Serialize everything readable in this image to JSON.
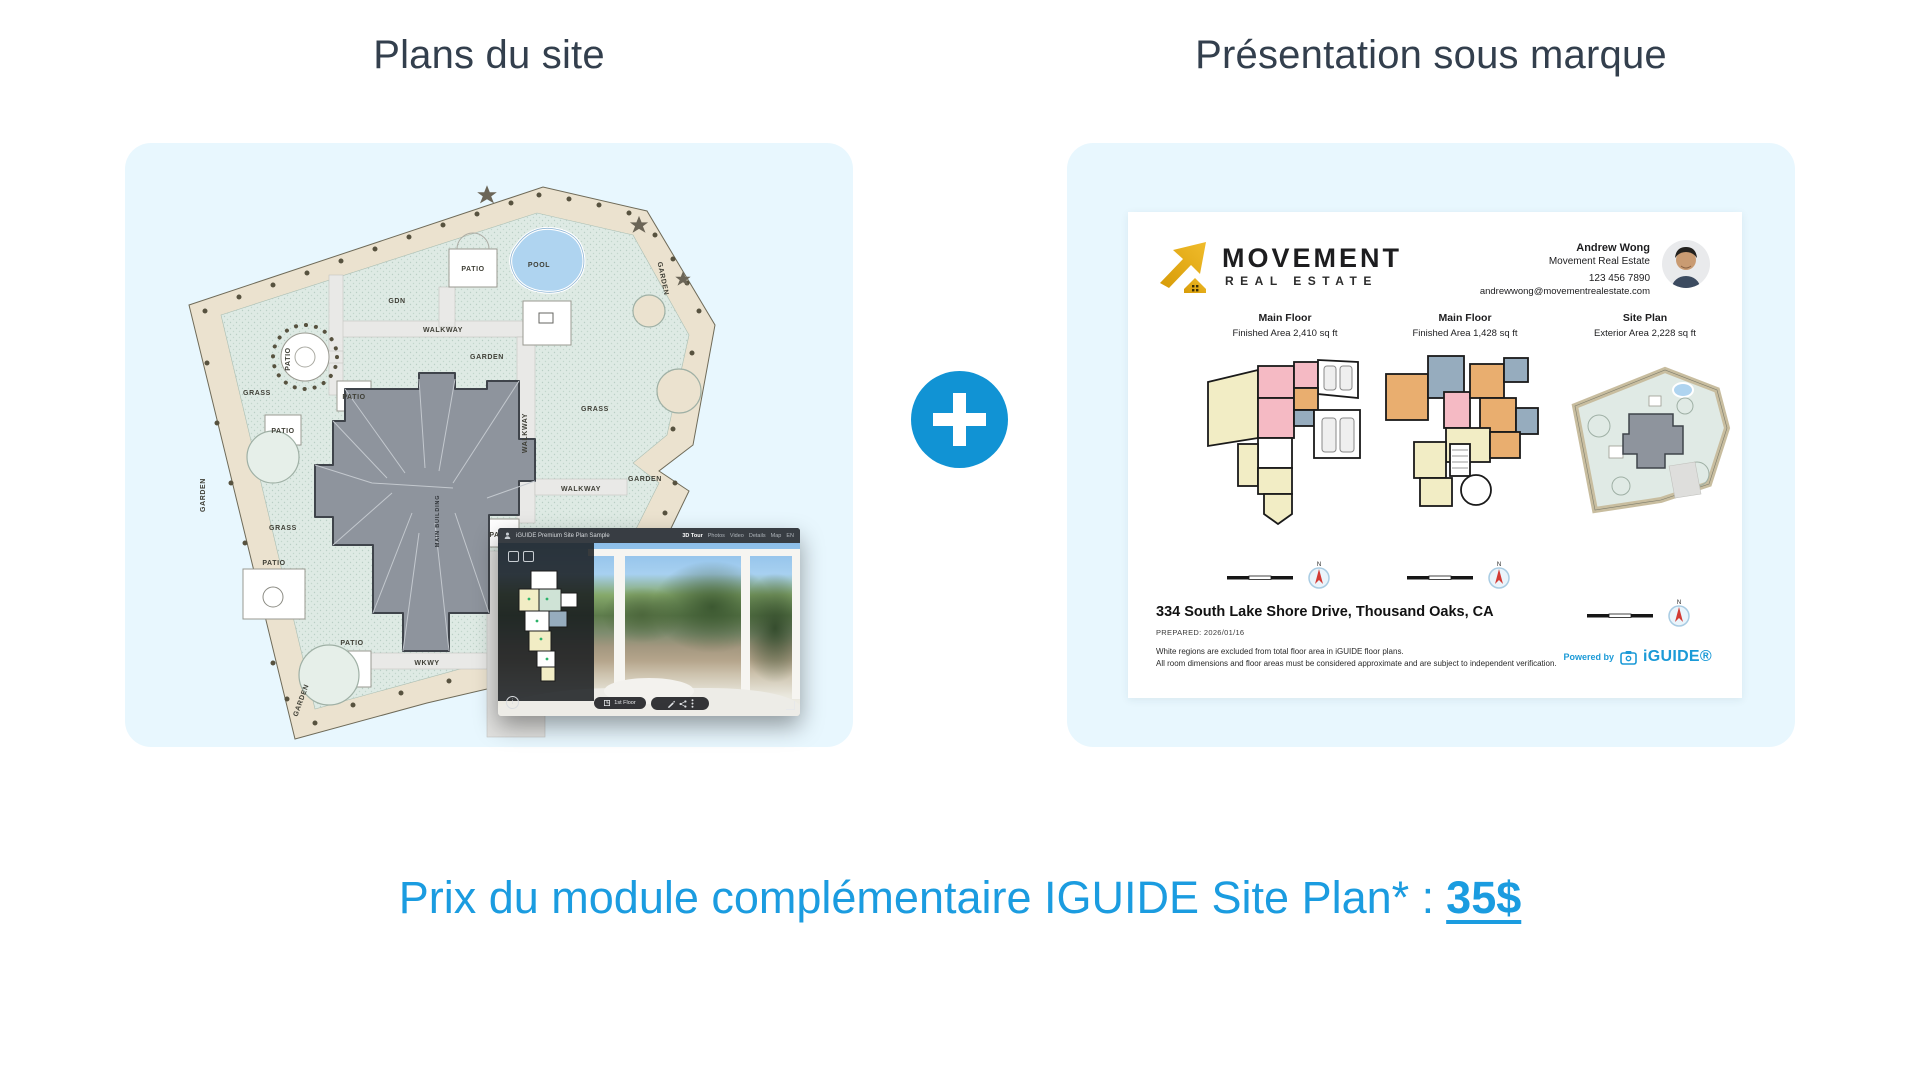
{
  "colors": {
    "accent_text": "#1B9CE0",
    "accent_circle": "#1193D4",
    "card_bg": "#E8F7FE",
    "title": "#333F4D",
    "gold": "#E8B11E",
    "iguide_blue": "#1B9AD7"
  },
  "left_section": {
    "title": "Plans du site",
    "site_plan": {
      "labels": [
        "POOL",
        "PATIO",
        "GARDEN",
        "WALKWAY",
        "GARDEN",
        "GDN",
        "GRASS",
        "GRASS",
        "PATIO",
        "PATIO",
        "PATIO",
        "WALKWAY",
        "WALKWAY",
        "GRASS",
        "GARDEN",
        "GRASS",
        "MAIN BUILDING",
        "PATIO",
        "WKWY",
        "SHED",
        "GRASS",
        "PATIO",
        "PATIO",
        "DRIVEWAY",
        "WKWY",
        "GARDEN",
        "GARDEN"
      ]
    }
  },
  "plus_divider": {
    "symbol": "+"
  },
  "tour_overlay": {
    "topbar_title": "iGUIDE Premium Site Plan Sample",
    "nav": [
      "3D Tour",
      "Photos",
      "Video",
      "Details",
      "Map",
      "EN"
    ],
    "floor_pill": "1st Floor",
    "info_glyph": "i"
  },
  "right_section": {
    "title": "Présentation sous marque",
    "presentation": {
      "brand": {
        "line1": "MOVEMENT",
        "line2": "REAL ESTATE"
      },
      "agent": {
        "name": "Andrew Wong",
        "company": "Movement Real Estate",
        "phone": "123 456 7890",
        "email": "andrewwong@movementrealestate.com"
      },
      "columns": [
        {
          "title": "Main Floor",
          "subtitle": "Finished Area 2,410 sq ft"
        },
        {
          "title": "Main Floor",
          "subtitle": "Finished Area 1,428 sq ft"
        },
        {
          "title": "Site Plan",
          "subtitle": "Exterior Area 2,228 sq ft"
        }
      ],
      "compass_n": "N",
      "address": "334 South Lake Shore Drive, Thousand Oaks, CA",
      "prepared": "PREPARED: 2026/01/16",
      "disclaimer_line1": "White regions are excluded from total floor area in iGUIDE floor plans.",
      "disclaimer_line2": "All room dimensions and floor areas must be considered approximate and are subject to independent verification.",
      "powered_by": "Powered by",
      "powered_brand": "iGUIDE®"
    }
  },
  "price_line": {
    "prefix": "Prix du module complémentaire IGUIDE Site Plan* :",
    "price": "35$"
  }
}
